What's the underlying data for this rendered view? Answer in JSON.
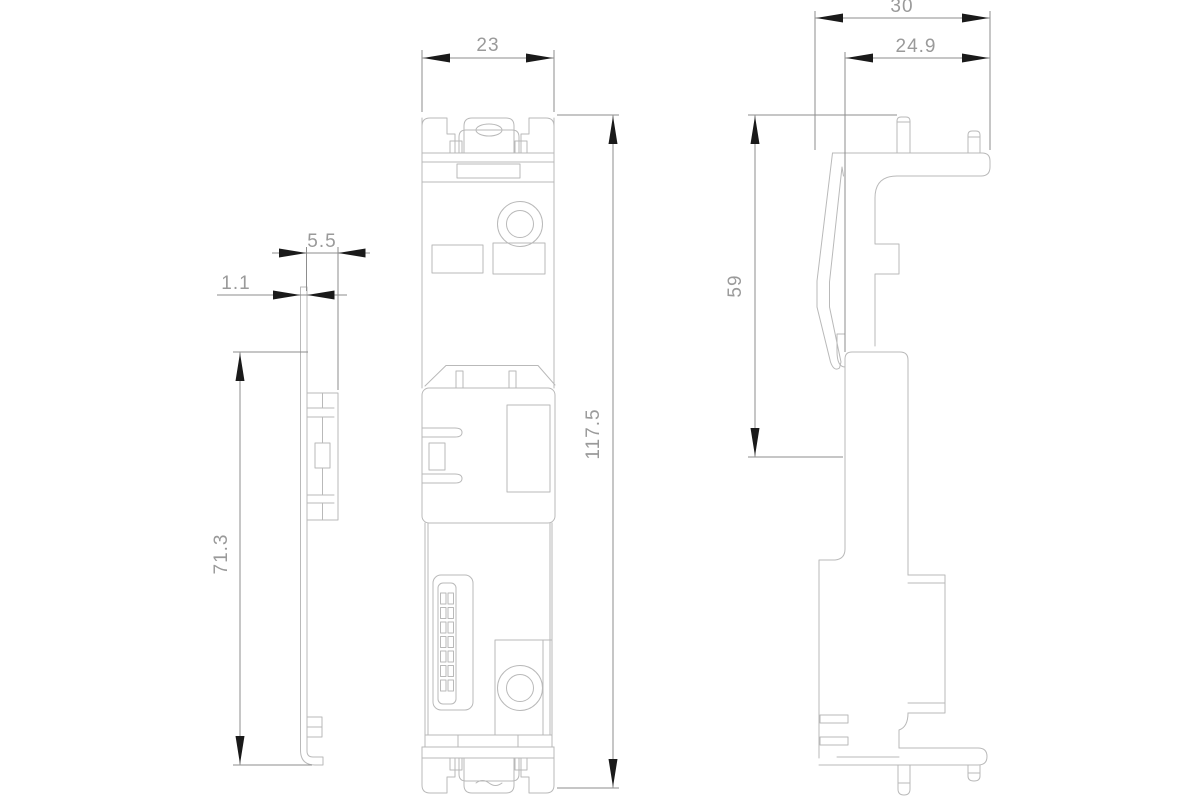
{
  "drawing": {
    "kind": "engineering-dimension-drawing",
    "style": {
      "background": "#ffffff",
      "outline_color": "#b9b9b9",
      "dimension_line_color": "#8d8d8d",
      "arrow_color": "#1a1a1a",
      "text_color": "#9a9a9a"
    },
    "views": {
      "left": {
        "name": "side-profile-left-view"
      },
      "center": {
        "name": "front-view"
      },
      "right": {
        "name": "side-profile-right-view"
      }
    },
    "dimensions": {
      "flange_depth": {
        "value": "5.5",
        "orientation": "horizontal",
        "view": "side-profile-left-view"
      },
      "wall_thickness": {
        "value": "1.1",
        "orientation": "horizontal",
        "view": "side-profile-left-view"
      },
      "bracket_height": {
        "value": "71.3",
        "orientation": "vertical",
        "view": "side-profile-left-view"
      },
      "front_width": {
        "value": "23",
        "orientation": "horizontal",
        "view": "front-view"
      },
      "overall_height": {
        "value": "117.5",
        "orientation": "vertical",
        "view": "front-view"
      },
      "overall_depth": {
        "value": "30",
        "orientation": "horizontal",
        "view": "side-profile-right-view"
      },
      "body_depth": {
        "value": "24.9",
        "orientation": "horizontal",
        "view": "side-profile-right-view"
      },
      "upper_height": {
        "value": "59",
        "orientation": "vertical",
        "view": "side-profile-right-view"
      }
    }
  }
}
